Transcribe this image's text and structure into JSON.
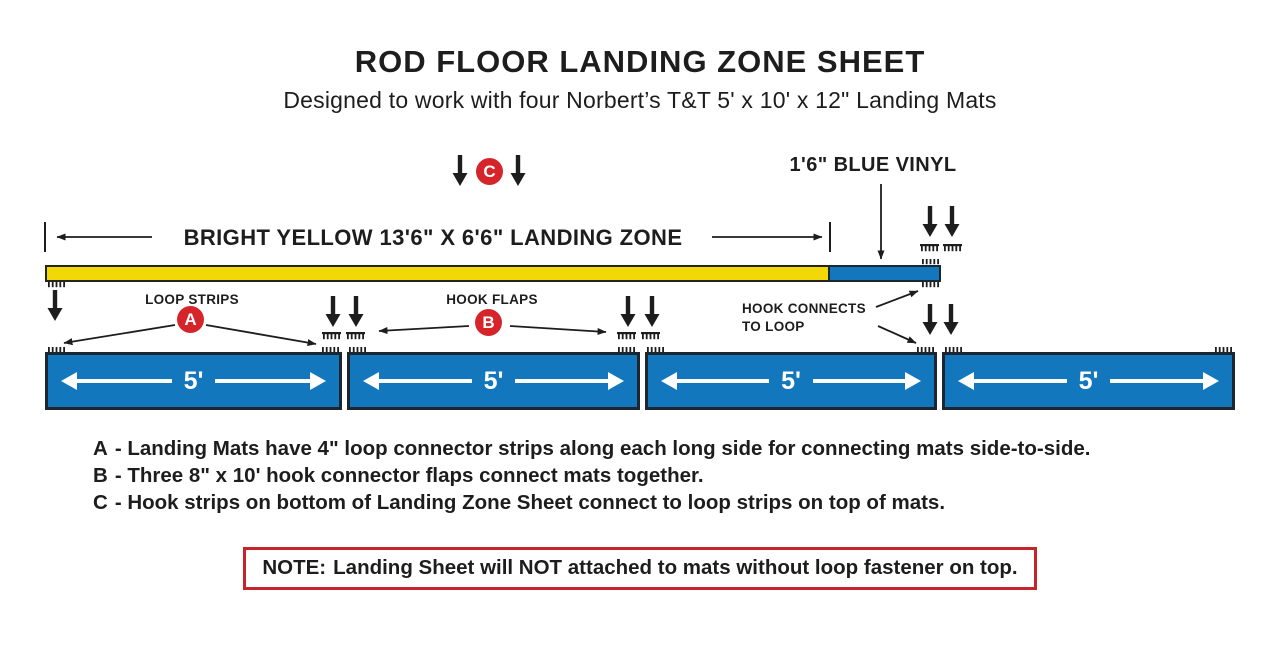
{
  "title": "ROD FLOOR LANDING ZONE SHEET",
  "subtitle": "Designed to work with four Norbert’s T&T 5' x 10' x 12\" Landing Mats",
  "diagram": {
    "blue_vinyl_label": "1'6\" BLUE VINYL",
    "landing_zone_label": "BRIGHT YELLOW 13'6\" X 6'6\" LANDING ZONE",
    "loop_strips_label": "LOOP STRIPS",
    "hook_flaps_label": "HOOK FLAPS",
    "hook_connects_line1": "HOOK CONNECTS",
    "hook_connects_line2": "TO LOOP",
    "marker_a": "A",
    "marker_b": "B",
    "marker_c": "C",
    "mats": [
      {
        "label": "5'"
      },
      {
        "label": "5'"
      },
      {
        "label": "5'"
      },
      {
        "label": "5'"
      }
    ]
  },
  "legend": [
    {
      "letter": "A",
      "text": "- Landing Mats have 4\" loop connector strips along each long side for connecting mats side-to-side."
    },
    {
      "letter": "B",
      "text": "- Three 8\" x 10' hook connector flaps connect mats together."
    },
    {
      "letter": "C",
      "text": "- Hook strips on bottom of Landing Zone Sheet connect to loop strips on top of mats."
    }
  ],
  "note": {
    "label": "NOTE:",
    "text": "Landing Sheet will NOT attached to mats without loop fastener on top."
  },
  "colors": {
    "yellow": "#F2D807",
    "blue": "#1277BD",
    "mat-border": "#1B2631",
    "red": "#D6242B",
    "note-red": "#C4242B",
    "ink": "#1D1D1D"
  }
}
